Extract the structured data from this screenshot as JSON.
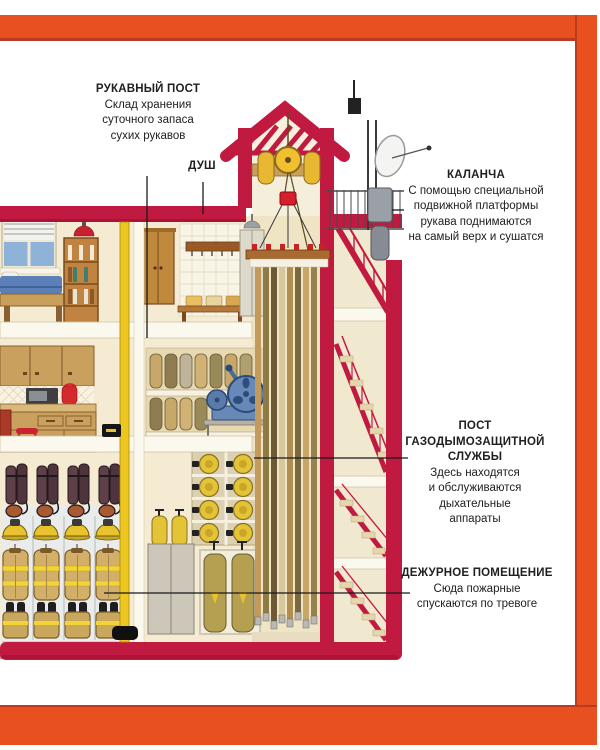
{
  "colors": {
    "frame_orange": "#E8501F",
    "frame_shadow": "#BB3A22",
    "building_crimson": "#C11A40",
    "wall_cream": "#F4EBD2",
    "pole_yellow": "#EDC620",
    "text": "#202020"
  },
  "annotations": {
    "hose_post": {
      "title": "РУКАВНЫЙ ПОСТ",
      "body": "Склад хранения\nсуточного запаса\nсухих рукавов"
    },
    "shower": {
      "title": "ДУШ"
    },
    "watchtower": {
      "title": "КАЛАНЧА",
      "body": "С помощью специальной\nподвижной платформы\nрукава поднимаются\nна самый верх и сушатся"
    },
    "smoke_protection": {
      "title": "ПОСТ\nГАЗОДЫМОЗАЩИТНОЙ\nСЛУЖБЫ",
      "body": "Здесь находятся\nи обслуживаются\nдыхательные\nаппараты"
    },
    "duty_room": {
      "title": "ДЕЖУРНОЕ ПОМЕЩЕНИЕ",
      "body": "Сюда пожарные\nспускаются по тревоге"
    }
  }
}
